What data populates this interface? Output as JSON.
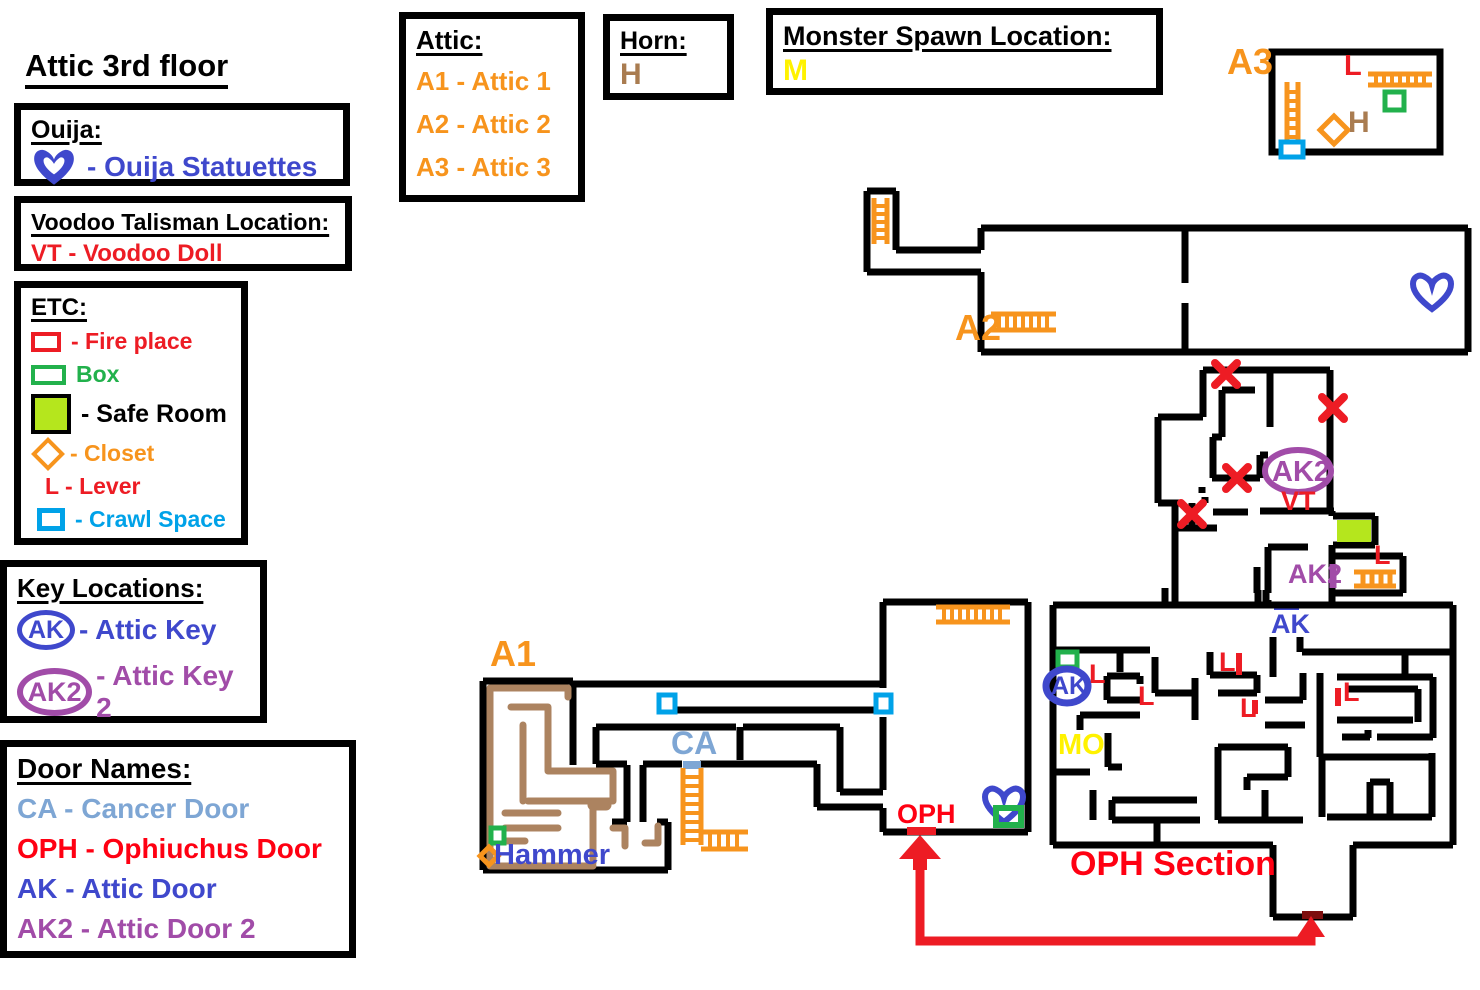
{
  "title": "Attic 3rd floor",
  "boxes": {
    "ouija": {
      "heading": "Ouija:",
      "entry": "- Ouija Statuettes"
    },
    "voodoo": {
      "heading": "Voodoo Talisman Location:",
      "entry": "VT - Voodoo Doll"
    },
    "etc": {
      "heading": "ETC:",
      "fireplace": "- Fire place",
      "box": "Box",
      "safe_room": "- Safe Room",
      "closet": "- Closet",
      "lever": "L - Lever",
      "crawl_space": "- Crawl Space"
    },
    "keys": {
      "heading": "Key Locations:",
      "ak_badge": "AK",
      "ak_label": "- Attic Key",
      "ak2_badge": "AK2",
      "ak2_label": "- Attic Key 2"
    },
    "doors": {
      "heading": "Door Names:",
      "ca": "CA - Cancer Door",
      "oph": "OPH - Ophiuchus Door",
      "ak": "AK - Attic Door",
      "ak2": "AK2 - Attic Door 2"
    },
    "attic": {
      "heading": "Attic:",
      "a1": "A1 - Attic 1",
      "a2": "A2 - Attic 2",
      "a3": "A3 - Attic 3"
    },
    "horn": {
      "heading": "Horn:",
      "entry": "H"
    },
    "monster": {
      "heading": "Monster Spawn Location:",
      "entry": "M"
    }
  },
  "map": {
    "labels": {
      "a1": "A1",
      "a2": "A2",
      "a3": "A3",
      "ca": "CA",
      "oph": "OPH",
      "oph_section": "OPH Section",
      "mo": "MO",
      "ak_door": "AK",
      "ak_key_badge": "AK",
      "ak2_ellipse": "AK2",
      "ak2_text": "AK2",
      "vt": "VT",
      "hammer": "Hammer",
      "h": "H",
      "lever": "L"
    }
  },
  "colors": {
    "orange": "#F7941D",
    "brown": "#A97C50",
    "path_brown": "#AC8360",
    "red": "#ED1C24",
    "dark_red": "#7D0E0E",
    "blue": "#3F48CC",
    "steel_blue": "#7EA6D4",
    "purple": "#A14CA8",
    "green": "#22B14C",
    "safe_lime": "#B5E61D",
    "cyan": "#00A2E8",
    "yellow": "#FFF200",
    "black": "#000000"
  }
}
